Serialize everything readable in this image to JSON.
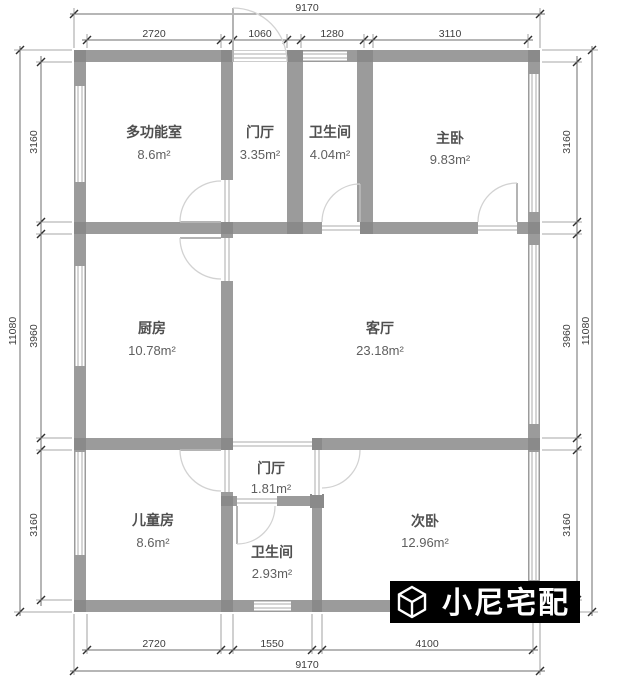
{
  "plan": {
    "type": "residential-floor-plan",
    "unit": "mm",
    "colors": {
      "wall": "#9b9b9b",
      "wall_junction": "#8a8a8a",
      "dimension_text": "#3d3d3d",
      "room_text": "#4f4f4f",
      "background": "#ffffff",
      "watermark_bg": "#000000",
      "watermark_fg": "#ffffff"
    }
  },
  "rooms": [
    {
      "name": "多功能室",
      "area": "8.6m²"
    },
    {
      "name": "门厅",
      "area": "3.35m²"
    },
    {
      "name": "卫生间",
      "area": "4.04m²"
    },
    {
      "name": "主卧",
      "area": "9.83m²"
    },
    {
      "name": "厨房",
      "area": "10.78m²"
    },
    {
      "name": "客厅",
      "area": "23.18m²"
    },
    {
      "name": "门厅",
      "area": "1.81m²"
    },
    {
      "name": "儿童房",
      "area": "8.6m²"
    },
    {
      "name": "卫生间",
      "area": "2.93m²"
    },
    {
      "name": "次卧",
      "area": "12.96m²"
    }
  ],
  "dimensions": {
    "top": {
      "overall": "9170",
      "segments": [
        "2720",
        "1060",
        "1280",
        "3110"
      ]
    },
    "bottom": {
      "overall": "9170",
      "segments": [
        "2720",
        "1550",
        "4100"
      ]
    },
    "left": {
      "overall": "11080",
      "segments": [
        "3160",
        "3960",
        "3160"
      ]
    },
    "right": {
      "overall": "11080",
      "segments": [
        "3160",
        "3960",
        "3160"
      ]
    }
  },
  "watermark": {
    "brand": "小尼宅配",
    "logo": "cube-logo"
  }
}
